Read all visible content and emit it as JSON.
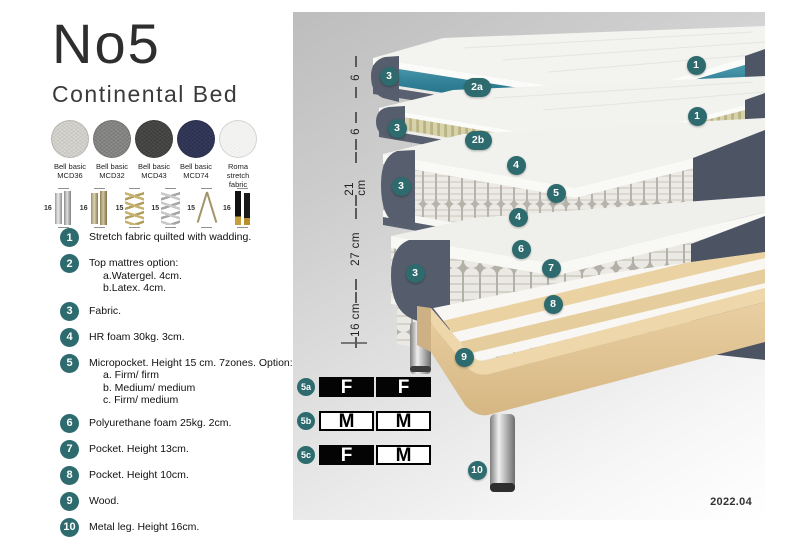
{
  "header": {
    "title": "No5",
    "subtitle": "Continental Bed"
  },
  "colors": {
    "accent_teal": "#2d6b6f",
    "watergel_teal": "#2f7f96",
    "fabric_dark": "#565d6c",
    "latex_cream": "#d8d2aa",
    "wood": "#e0c492"
  },
  "swatches": [
    {
      "line1": "Bell basic",
      "line2": "MCD36",
      "base": "#e8e6e1",
      "dot": "#c9c7c2"
    },
    {
      "line1": "Bell basic",
      "line2": "MCD32",
      "base": "#9c9c9a",
      "dot": "#7c7c7a"
    },
    {
      "line1": "Bell basic",
      "line2": "MCD43",
      "base": "#585856",
      "dot": "#3f3f3d"
    },
    {
      "line1": "Bell basic",
      "line2": "MCD74",
      "base": "#3f4568",
      "dot": "#2c3150"
    },
    {
      "line1": "Roma",
      "line2": "stretch fabric",
      "base": "#fbfbfb",
      "dot": "#efefed"
    }
  ],
  "legs": [
    {
      "size": "16",
      "type": "cylinder-silver"
    },
    {
      "size": "16",
      "type": "cylinder-gold"
    },
    {
      "size": "15",
      "type": "twist-gold"
    },
    {
      "size": "15",
      "type": "twist-silver"
    },
    {
      "size": "15",
      "type": "hairpin"
    },
    {
      "size": "16",
      "type": "block-black"
    }
  ],
  "legend": [
    {
      "num": "1",
      "lines": [
        "Stretch fabric quilted with wadding."
      ]
    },
    {
      "num": "2",
      "lines": [
        "Top mattres option:",
        "a.Watergel. 4cm.",
        "b.Latex. 4cm."
      ]
    },
    {
      "num": "3",
      "lines": [
        "Fabric."
      ]
    },
    {
      "num": "4",
      "lines": [
        "HR foam 30kg. 3cm."
      ]
    },
    {
      "num": "5",
      "lines": [
        "Micropocket. Height 15 cm. 7zones. Option:",
        "a. Firm/ firm",
        "b. Medium/ medium",
        "c. Firm/ medium"
      ]
    },
    {
      "num": "6",
      "lines": [
        "Polyurethane foam 25kg. 2cm."
      ]
    },
    {
      "num": "7",
      "lines": [
        "Pocket. Height 13cm."
      ]
    },
    {
      "num": "8",
      "lines": [
        "Pocket. Height 10cm."
      ]
    },
    {
      "num": "9",
      "lines": [
        "Wood."
      ]
    },
    {
      "num": "10",
      "lines": [
        "Metal leg. Height 16cm."
      ]
    }
  ],
  "ruler": [
    {
      "label": "6",
      "top": 44,
      "height": 42
    },
    {
      "label": "6",
      "top": 100,
      "height": 38
    },
    {
      "label": "21 cm",
      "top": 140,
      "height": 54
    },
    {
      "label": "27 cm",
      "top": 196,
      "height": 82
    },
    {
      "label": "16 cm",
      "top": 280,
      "height": 56
    }
  ],
  "callouts": [
    {
      "label": "1",
      "x": 403,
      "y": 53
    },
    {
      "label": "2a",
      "x": 184,
      "y": 75,
      "pill": true
    },
    {
      "label": "3",
      "x": 96,
      "y": 64
    },
    {
      "label": "1",
      "x": 404,
      "y": 104
    },
    {
      "label": "2b",
      "x": 185,
      "y": 128,
      "pill": true
    },
    {
      "label": "3",
      "x": 104,
      "y": 116
    },
    {
      "label": "4",
      "x": 223,
      "y": 153
    },
    {
      "label": "5",
      "x": 263,
      "y": 181
    },
    {
      "label": "3",
      "x": 108,
      "y": 174
    },
    {
      "label": "4",
      "x": 225,
      "y": 205
    },
    {
      "label": "6",
      "x": 228,
      "y": 237
    },
    {
      "label": "7",
      "x": 258,
      "y": 256
    },
    {
      "label": "3",
      "x": 122,
      "y": 261
    },
    {
      "label": "8",
      "x": 260,
      "y": 292
    },
    {
      "label": "9",
      "x": 171,
      "y": 345
    },
    {
      "label": "10",
      "x": 184,
      "y": 458
    }
  ],
  "firmness": {
    "rows": [
      {
        "label": "5a",
        "cells": [
          {
            "text": "F",
            "variant": "dark"
          },
          {
            "text": "F",
            "variant": "dark"
          }
        ]
      },
      {
        "label": "5b",
        "cells": [
          {
            "text": "M",
            "variant": "light"
          },
          {
            "text": "M",
            "variant": "light"
          }
        ]
      },
      {
        "label": "5c",
        "cells": [
          {
            "text": "F",
            "variant": "dark"
          },
          {
            "text": "M",
            "variant": "light"
          }
        ]
      }
    ]
  },
  "version": "2022.04"
}
